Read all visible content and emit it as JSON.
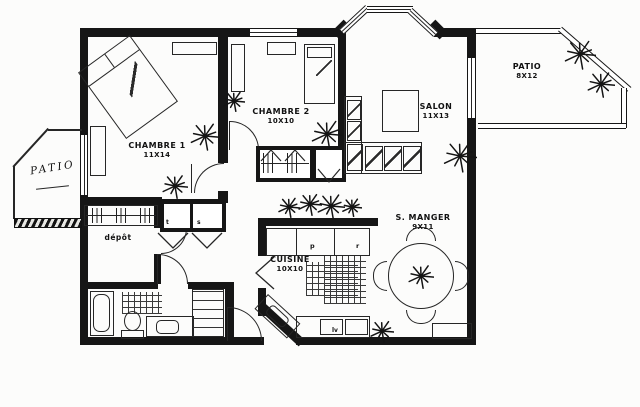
{
  "meta": {
    "type": "apartment floor plan"
  },
  "rooms": {
    "chambre1": {
      "name": "CHAMBRE 1",
      "dims": "11X14"
    },
    "chambre2": {
      "name": "CHAMBRE 2",
      "dims": "10X10"
    },
    "salon": {
      "name": "SALON",
      "dims": "11X13"
    },
    "cuisine": {
      "name": "CUISINE",
      "dims": "10X10"
    },
    "salle_a_manger": {
      "name": "S. MANGER",
      "dims": "9X11"
    },
    "depot": {
      "name": "dépôt"
    },
    "patio_right": {
      "name": "PATIO",
      "dims": "8X12"
    },
    "patio_left": {
      "name": "PATIO"
    }
  },
  "fixtures": {
    "closet_t": "t",
    "closet_s": "s",
    "stove_p": "p",
    "fridge_r": "r",
    "dishwasher_lv": "lv"
  },
  "colors": {
    "wall": "#161616",
    "line": "#262626",
    "background": "#fcfcfb"
  }
}
